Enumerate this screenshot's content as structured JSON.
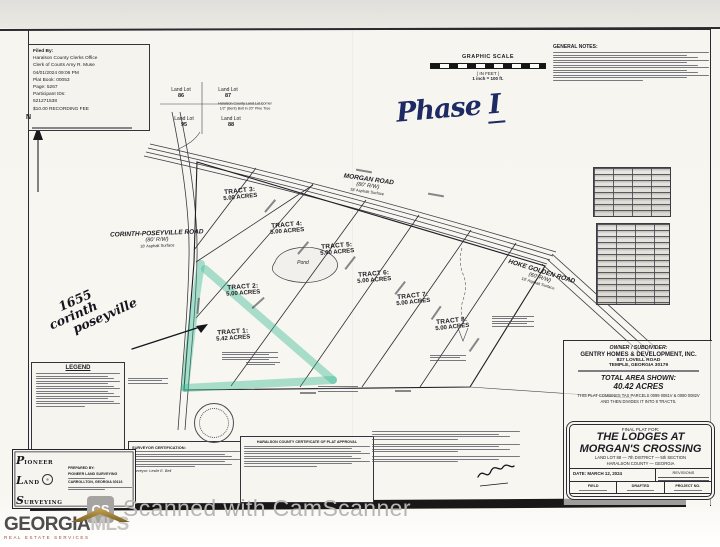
{
  "watermarks": {
    "camscanner": {
      "icon": "CS",
      "text": "Scanned with CamScanner"
    },
    "georgiamls": {
      "brand_primary": "GEORGIA",
      "brand_secondary": "MLS",
      "tagline": "REAL ESTATE SERVICES"
    }
  },
  "handwriting": {
    "phase_word": "Phase",
    "phase_numeral": "I",
    "address_line1": "1655",
    "address_line2": "corinth",
    "address_line3": "poseyville"
  },
  "filing_stamp": {
    "lines": [
      "Filed By:",
      "Haralson County Clerks Office",
      "Clerk of Courts Amy R. Muse",
      "04/01/2024 09:06 PM",
      "Plat Book: 00053",
      "Page: 5267",
      "Participant IDs:",
      "521271538",
      "$10.00 RECORDING FEE"
    ]
  },
  "graphic_scale": {
    "title": "GRAPHIC SCALE",
    "units": "( IN FEET )",
    "ratio": "1 inch = 100 ft."
  },
  "general_notes_title": "GENERAL NOTES:",
  "north_label": "N",
  "land_lots": {
    "tl": {
      "l1": "Land Lot",
      "l2": "86"
    },
    "tr": {
      "l1": "Land Lot",
      "l2": "87"
    },
    "bl": {
      "l1": "Land Lot",
      "l2": "95"
    },
    "br": {
      "l1": "Land Lot",
      "l2": "88"
    },
    "corner_note1": "Haralson County Land Lot Corner",
    "corner_note2": "1/2\" (Bent) Bolt in 20\" Pine Tree"
  },
  "roads": {
    "morgan": {
      "name": "MORGAN ROAD",
      "rw": "(80' R/W)",
      "surface": "18' Asphalt Surface"
    },
    "corinth": {
      "name": "CORINTH-POSEYVILLE ROAD",
      "rw": "(80' R/W)",
      "surface": "18' Asphalt Surface"
    },
    "hoke": {
      "name": "HOKE GOLDEN ROAD",
      "rw": "(60' R/W)",
      "surface": "18' Asphalt Surface"
    }
  },
  "tracts": [
    {
      "name": "TRACT 1:",
      "acres": "5.42 ACRES"
    },
    {
      "name": "TRACT 2:",
      "acres": "5.00 ACRES"
    },
    {
      "name": "TRACT 3:",
      "acres": "5.00 ACRES"
    },
    {
      "name": "TRACT 4:",
      "acres": "5.00 ACRES"
    },
    {
      "name": "TRACT 5:",
      "acres": "5.00 ACRES"
    },
    {
      "name": "TRACT 6:",
      "acres": "5.00 ACRES"
    },
    {
      "name": "TRACT 7:",
      "acres": "5.00 ACRES"
    },
    {
      "name": "TRACT 8:",
      "acres": "5.00 ACRES"
    }
  ],
  "pond_label": "Pond",
  "owner_block": {
    "title": "OWNER / SUBDIVIDER:",
    "name": "GENTRY HOMES & DEVELOPMENT, INC.",
    "address1": "827 LOVELL ROAD",
    "address2": "TEMPLE, GEORGIA 30179",
    "total_label": "TOTAL AREA SHOWN:",
    "total_value": "40.42 ACRES",
    "combine_note1": "THIS PLAT COMBINES TAX PARCELS 0099 0081V & 0080 0082V",
    "combine_note2": "AND THEN DIVIDES IT INTO 8 TRACTS."
  },
  "title_block": {
    "prefix": "FINAL PLAT FOR:",
    "line1": "THE LODGES AT",
    "line2": "MORGAN'S CROSSING",
    "line3": "LAND LOT 88  —  7th DISTRICT  —  5th SECTION",
    "line4": "HARALSON COUNTY  —  GEORGIA",
    "date_label": "DATE:",
    "date_value": "MARCH 12, 2024",
    "revisions_label": "REVISIONS",
    "cells": [
      "FIELD",
      "DRAFTED",
      "PROJECT NO."
    ]
  },
  "legend_title": "LEGEND",
  "surveyor_box": {
    "i1": "P",
    "r1": "IONEER",
    "i2": "L",
    "r2": "AND",
    "i3": "S",
    "r3": "URVEYING",
    "prepared_label": "PREPARED BY:",
    "firm": "PIONEER LAND SURVEYING",
    "city": "CARROLLTON, GEORGIA 30116"
  },
  "certification": {
    "title": "SURVEYOR CERTIFICATION:",
    "signer": "Surveyor: Leslie E. Bell"
  },
  "approval": {
    "title": "HARALSON COUNTY CERTIFICATE OF PLAT APPROVAL"
  }
}
